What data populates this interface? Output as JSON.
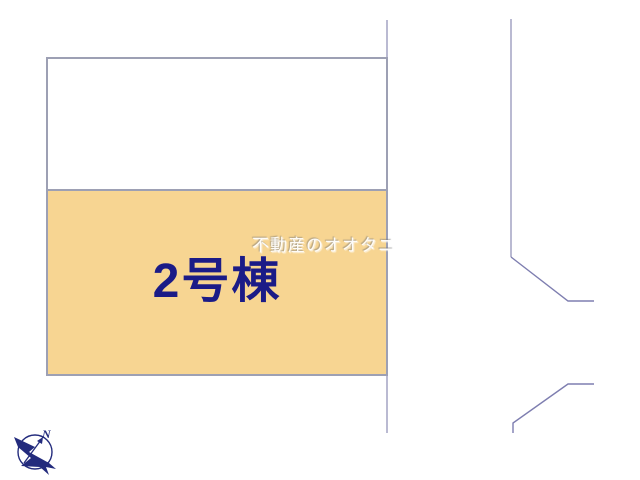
{
  "plot_map": {
    "building_label": "2号棟",
    "watermark": "不動産のオオタニ",
    "colors": {
      "parcel_upper_fill": "#ffffff",
      "parcel_fill": "#f7d592",
      "boundary": "#9da0b4",
      "road_line": "#7e7eb0",
      "label_navy": "#1b1b87",
      "compass_navy": "#232b7d"
    },
    "compass": {
      "north_label": "N"
    }
  }
}
